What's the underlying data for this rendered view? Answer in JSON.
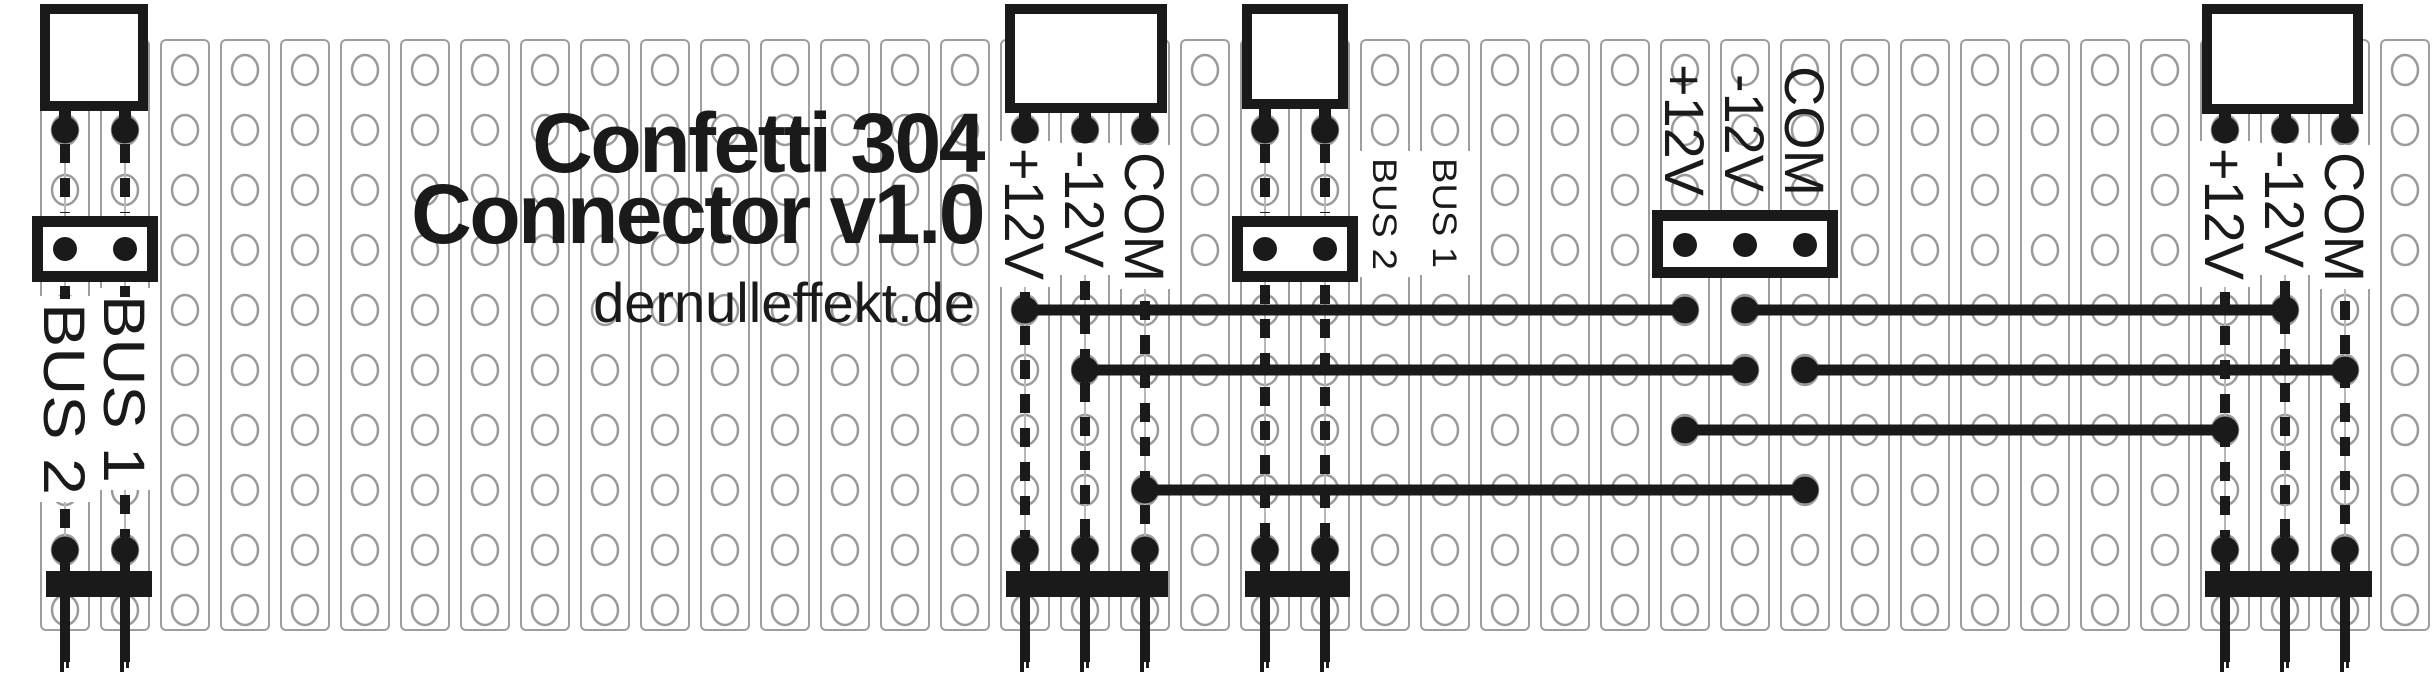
{
  "title": {
    "line1": "Confetti 304",
    "line2": "Connector v1.0",
    "website": "dernulleffekt.de"
  },
  "colors": {
    "ink": "#1a1a1a",
    "strip_stroke": "#9e9e9e",
    "hole_stroke": "#9a9a9a",
    "trace_line": "#b8b8b8",
    "background": "#ffffff"
  },
  "board": {
    "width": 2432,
    "height": 680,
    "strip_top": 40,
    "strip_bottom": 630,
    "strip_width": 48,
    "col_start": 65,
    "col_pitch": 60,
    "col_count": 40,
    "hole_row_start": 70,
    "hole_row_pitch": 60,
    "hole_row_count": 10,
    "hole_rx": 13,
    "hole_ry": 15
  },
  "connectors": [
    {
      "name": "connector-bus-left",
      "box": [
        40,
        4,
        108,
        107
      ],
      "pin_cols": [
        65,
        125
      ],
      "pin_dot_y": 130
    },
    {
      "name": "connector-power-middle",
      "box": [
        1005,
        4,
        162,
        109
      ],
      "pin_cols": [
        1025,
        1085,
        1145
      ],
      "pin_dot_y": 130
    },
    {
      "name": "connector-bus-middle",
      "box": [
        1242,
        4,
        106,
        105
      ],
      "pin_cols": [
        1265,
        1325
      ],
      "pin_dot_y": 130
    },
    {
      "name": "connector-power-right",
      "box": [
        2202,
        4,
        161,
        110
      ],
      "pin_cols": [
        2225,
        2285,
        2345
      ],
      "pin_dot_y": 130
    }
  ],
  "headers": [
    {
      "name": "header-bus-left",
      "box": [
        32,
        216,
        126,
        66
      ],
      "pin_cols": [
        65,
        125
      ],
      "pin_dot_y": 249
    },
    {
      "name": "header-bus-middle",
      "box": [
        1232,
        216,
        126,
        66
      ],
      "pin_cols": [
        1265,
        1325
      ],
      "pin_dot_y": 249
    },
    {
      "name": "header-power",
      "box": [
        1652,
        210,
        186,
        68
      ],
      "pin_cols": [
        1685,
        1745,
        1805
      ],
      "pin_dot_y": 245
    }
  ],
  "labels": [
    {
      "name": "label-bus1-left",
      "text": "BUS 1",
      "col": 125,
      "top": 295,
      "font": 58,
      "length": 188,
      "bg": true
    },
    {
      "name": "label-bus2-left",
      "text": "BUS 2",
      "col": 65,
      "top": 303,
      "font": 58,
      "length": 192,
      "bg": true
    },
    {
      "name": "label-plus12v-middle",
      "text": "+12V",
      "col": 1025,
      "top": 148,
      "font": 56,
      "length": 132,
      "bg": true
    },
    {
      "name": "label-minus12v-middle",
      "text": "-12V",
      "col": 1085,
      "top": 150,
      "font": 56,
      "length": 118,
      "bg": true
    },
    {
      "name": "label-com-middle",
      "text": "COM",
      "col": 1145,
      "top": 152,
      "font": 56,
      "length": 130,
      "bg": true
    },
    {
      "name": "label-bus1-middle",
      "text": "BUS 1",
      "col": 1445,
      "top": 158,
      "font": 34,
      "length": 110,
      "bg": true
    },
    {
      "name": "label-bus2-middle",
      "text": "BUS 2",
      "col": 1385,
      "top": 158,
      "font": 34,
      "length": 112,
      "bg": true
    },
    {
      "name": "label-plus12v-header",
      "text": "+12V",
      "col": 1685,
      "top": 64,
      "font": 56,
      "length": 132,
      "bg": false
    },
    {
      "name": "label-minus12v-header",
      "text": "-12V",
      "col": 1745,
      "top": 74,
      "font": 56,
      "length": 118,
      "bg": false
    },
    {
      "name": "label-com-header",
      "text": "COM",
      "col": 1805,
      "top": 66,
      "font": 56,
      "length": 130,
      "bg": false
    },
    {
      "name": "label-plus12v-right",
      "text": "+12V",
      "col": 2225,
      "top": 148,
      "font": 56,
      "length": 132,
      "bg": true
    },
    {
      "name": "label-minus12v-right",
      "text": "-12V",
      "col": 2285,
      "top": 150,
      "font": 56,
      "length": 118,
      "bg": true
    },
    {
      "name": "label-com-right",
      "text": "COM",
      "col": 2345,
      "top": 152,
      "font": 56,
      "length": 130,
      "bg": true
    }
  ],
  "dashed_runs": [
    {
      "col": 65,
      "runs": [
        [
          144,
          213
        ],
        [
          286,
          299
        ],
        [
          509,
          537
        ]
      ]
    },
    {
      "col": 125,
      "runs": [
        [
          144,
          213
        ],
        [
          286,
          297
        ],
        [
          495,
          537
        ]
      ]
    },
    {
      "col": 1025,
      "runs": [
        [
          292,
          537
        ]
      ]
    },
    {
      "col": 1085,
      "runs": [
        [
          281,
          537
        ]
      ]
    },
    {
      "col": 1145,
      "runs": [
        [
          301,
          537
        ]
      ]
    },
    {
      "col": 1265,
      "runs": [
        [
          144,
          213
        ],
        [
          285,
          537
        ]
      ]
    },
    {
      "col": 1325,
      "runs": [
        [
          144,
          213
        ],
        [
          285,
          537
        ]
      ]
    },
    {
      "col": 2225,
      "runs": [
        [
          292,
          537
        ]
      ]
    },
    {
      "col": 2285,
      "runs": [
        [
          281,
          537
        ]
      ]
    },
    {
      "col": 2345,
      "runs": [
        [
          301,
          537
        ]
      ]
    }
  ],
  "wires": [
    {
      "name": "wire-plus12v-a",
      "net": "+12V",
      "y": 310,
      "x1": 1025,
      "x2": 1685
    },
    {
      "name": "wire-minus12v-b",
      "net": "-12V",
      "y": 310,
      "x1": 1745,
      "x2": 2285
    },
    {
      "name": "wire-minus12v-a",
      "net": "-12V",
      "y": 370,
      "x1": 1085,
      "x2": 1745
    },
    {
      "name": "wire-com-b",
      "net": "COM",
      "y": 370,
      "x1": 1805,
      "x2": 2345
    },
    {
      "name": "wire-plus12v-b",
      "net": "+12V",
      "y": 430,
      "x1": 1685,
      "x2": 2225
    },
    {
      "name": "wire-com-a",
      "net": "COM",
      "y": 490,
      "x1": 1145,
      "x2": 1805
    }
  ],
  "solder_bars": [
    {
      "name": "solder-bar-left",
      "x1": 46,
      "x2": 152,
      "pin_cols": [
        65,
        125
      ]
    },
    {
      "name": "solder-bar-power-middle",
      "x1": 1006,
      "x2": 1168,
      "pin_cols": [
        1025,
        1085,
        1145
      ]
    },
    {
      "name": "solder-bar-bus-middle",
      "x1": 1245,
      "x2": 1350,
      "pin_cols": [
        1265,
        1325
      ]
    },
    {
      "name": "solder-bar-right",
      "x1": 2205,
      "x2": 2372,
      "pin_cols": [
        2225,
        2285,
        2345
      ]
    }
  ],
  "bar_geom": {
    "y": 571,
    "height": 26,
    "pin_width": 10,
    "pin_top": 552,
    "pin_bottom": 662,
    "dot_y": 550
  },
  "dash_style": {
    "width": 10,
    "dash": 19,
    "gap": 15
  },
  "dot_radius": 13.5,
  "header_dot_radius": 12,
  "wire_width": 11
}
